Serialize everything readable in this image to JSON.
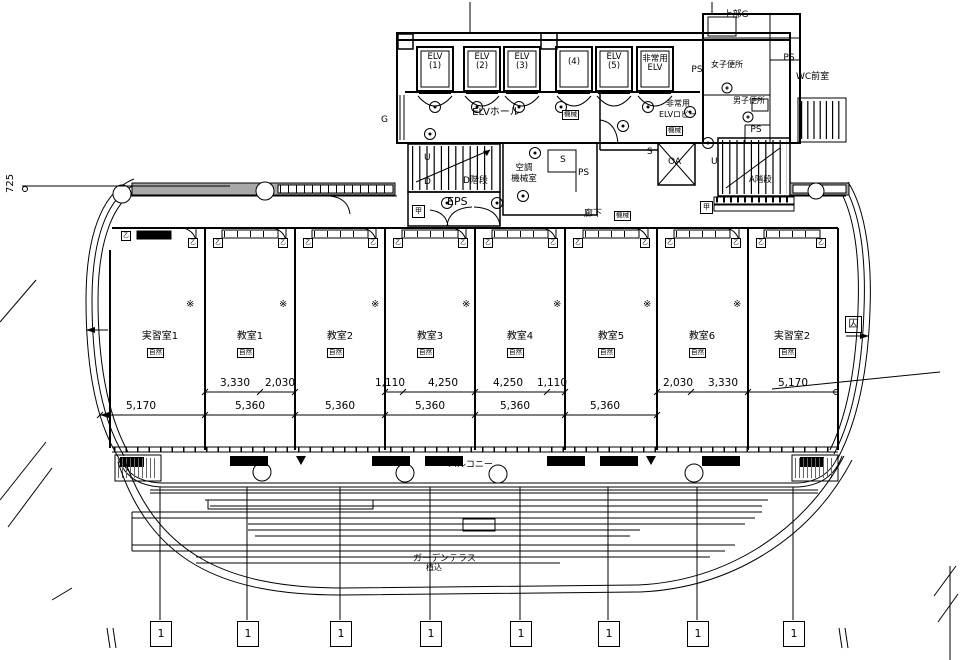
{
  "colors": {
    "line": "#000000",
    "band": "#a8a8a8",
    "bg": "#ffffff"
  },
  "core": {
    "elevators": [
      {
        "l1": "ELV",
        "l2": "(1)"
      },
      {
        "l1": "ELV",
        "l2": "(2)"
      },
      {
        "l1": "ELV",
        "l2": "(3)"
      },
      {
        "l1": "",
        "l2": "(4)"
      },
      {
        "l1": "ELV",
        "l2": "(5)"
      },
      {
        "l1": "非常用",
        "l2": "ELV"
      }
    ],
    "elv_hall": "ELVホール",
    "g_left": "G",
    "ps_beside_elv": "PS",
    "lobby_line1": "非常用",
    "lobby_line2": "ELVロビー",
    "stair_d": "D階段",
    "stair_a": "A階段",
    "eps": "EPS",
    "up": "U",
    "down": "D",
    "ac_room_line1": "空調",
    "ac_room_line2": "機械室",
    "s": "S",
    "ps": "PS",
    "oa": "OA",
    "corridor": "廊下"
  },
  "toilets": {
    "top_g": "上部G",
    "ps_top": "PS",
    "wc_ante": "WC前室",
    "women": "女子便所",
    "men": "男子便所",
    "ps_mid": "PS"
  },
  "badges": {
    "natural": "自然",
    "mechanical": "機械"
  },
  "symbols": {
    "smoke_vent": "※",
    "fire_door_otsu": "乙",
    "fire_door_ko": "甲",
    "exit": "囚",
    "grid_no": "1"
  },
  "rooms": [
    {
      "name": "実習室1"
    },
    {
      "name": "教室1"
    },
    {
      "name": "教室2"
    },
    {
      "name": "教室3"
    },
    {
      "name": "教室4"
    },
    {
      "name": "教室5"
    },
    {
      "name": "教室6"
    },
    {
      "name": "実習室2"
    }
  ],
  "dims": {
    "left": "725",
    "upper": [
      "3,330",
      "2,030",
      "1,110",
      "4,250",
      "4,250",
      "1,110",
      "2,030",
      "3,330",
      "5,170"
    ],
    "lower": [
      "5,170",
      "5,360",
      "5,360",
      "5,360",
      "5,360",
      "5,360"
    ]
  },
  "outdoor": {
    "balcony": "バルコニー",
    "terrace": "ガーデンテラス",
    "planting": "植込"
  }
}
